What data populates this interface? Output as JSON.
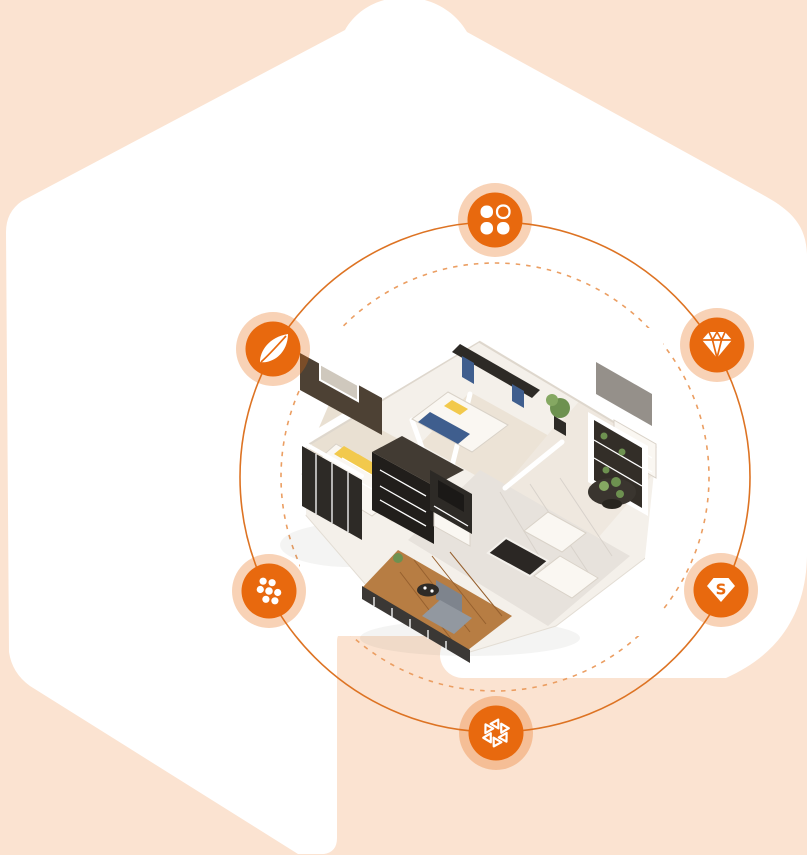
{
  "scene": {
    "colors": {
      "background": "#fbe3d1",
      "panel": "#ffffff",
      "accent": "#e8690e",
      "halo": "rgba(232,105,14,0.30)",
      "orbit_solid": "#dd7323",
      "orbit_dashed": "#eb9e62"
    }
  },
  "orbit": {
    "center_x": 495,
    "center_y": 477,
    "solid_radius": 255,
    "dashed_radius": 214
  },
  "badges": [
    {
      "id": "petals",
      "icon": "petals-icon"
    },
    {
      "id": "leaf",
      "icon": "leaf-icon"
    },
    {
      "id": "diamond",
      "icon": "diamond-icon"
    },
    {
      "id": "dots",
      "icon": "dots-cluster-icon"
    },
    {
      "id": "gem-s",
      "icon": "gem-s-icon",
      "letter": "S"
    },
    {
      "id": "triangles",
      "icon": "triangle-ring-icon"
    }
  ],
  "illustration": {
    "alt": "Isometric 3D cutaway floor plan of a furnished apartment"
  }
}
